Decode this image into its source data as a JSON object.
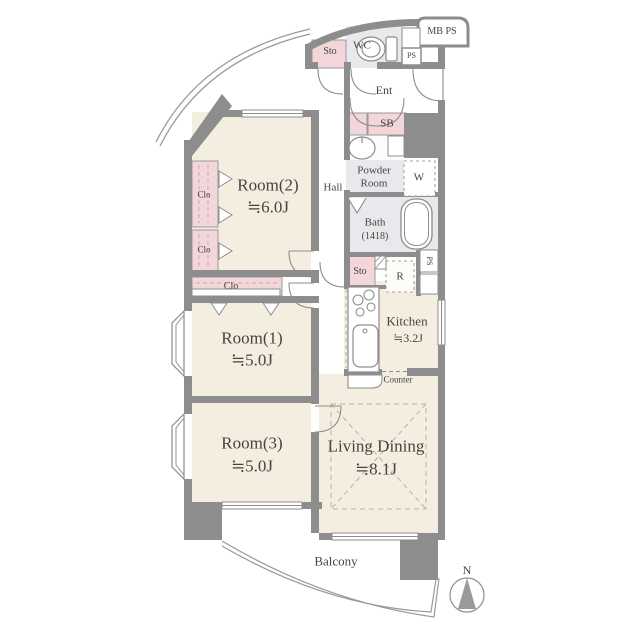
{
  "colors": {
    "wall": "#8d8d8d",
    "room_fill": "#f4eee1",
    "closet_fill": "#f2d6da",
    "wet_area_fill": "#e8e9ec",
    "text": "#45443e"
  },
  "icons": [
    "toilet-icon",
    "washbasin-icon",
    "bathtub-icon",
    "stove-icon",
    "kitchen-sink-icon",
    "compass-icon"
  ],
  "plan": {
    "rooms": {
      "room2": {
        "name": "Room(2)",
        "area": "≒6.0J"
      },
      "room1": {
        "name": "Room(1)",
        "area": "≒5.0J"
      },
      "room3": {
        "name": "Room(3)",
        "area": "≒5.0J"
      },
      "living_dining": {
        "name": "Living Dining",
        "area": "≒8.1J"
      },
      "kitchen": {
        "name": "Kitchen",
        "area": "≒3.2J"
      },
      "bath": {
        "name": "Bath",
        "size": "(1418)"
      },
      "powder_room": {
        "line1": "Powder",
        "line2": "Room"
      },
      "wc": {
        "name": "WC"
      },
      "hall": {
        "name": "Hall"
      },
      "entrance": {
        "name": "Ent"
      },
      "balcony": {
        "name": "Balcony"
      }
    },
    "storage": {
      "sto_top": "Sto",
      "sto_mid": "Sto",
      "shoe_box": "SB",
      "closet_1": "Clo",
      "closet_2": "Clo",
      "closet_3": "Clo"
    },
    "service": {
      "mb_ps": "MB PS",
      "ps_top": "PS",
      "ps_side": "PS",
      "washer": "W",
      "refrigerator": "R",
      "counter": "Counter"
    },
    "compass": {
      "north": "N"
    }
  }
}
